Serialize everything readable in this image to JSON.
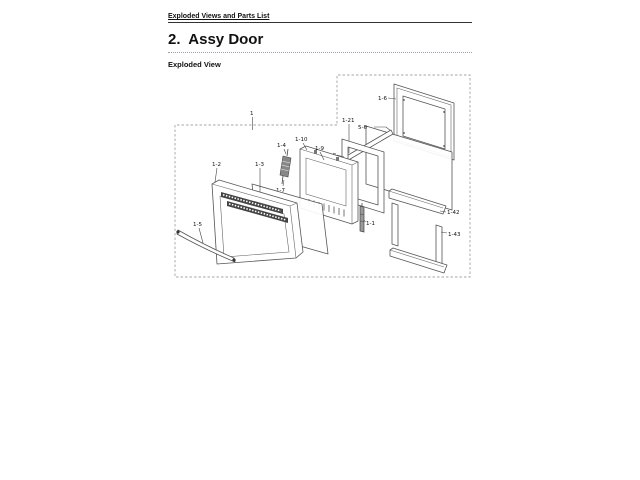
{
  "page": {
    "background": "#ffffff"
  },
  "header": {
    "breadcrumb": "Exploded Views and Parts List"
  },
  "section": {
    "title": "2.  Assy Door",
    "subtitle": "Exploded View"
  },
  "diagram": {
    "line_color": "#555555",
    "boundary_style": "dashed",
    "callouts": [
      {
        "label": "1"
      },
      {
        "label": "1-5"
      },
      {
        "label": "1-2"
      },
      {
        "label": "1-3"
      },
      {
        "label": "1-4"
      },
      {
        "label": "1-7"
      },
      {
        "label": "1-10"
      },
      {
        "label": "1-9"
      },
      {
        "label": "1-8"
      },
      {
        "label": "1-21"
      },
      {
        "label": "5-6"
      },
      {
        "label": "1-6"
      },
      {
        "label": "1-1"
      },
      {
        "label": "1-42"
      },
      {
        "label": "1-43"
      }
    ]
  }
}
